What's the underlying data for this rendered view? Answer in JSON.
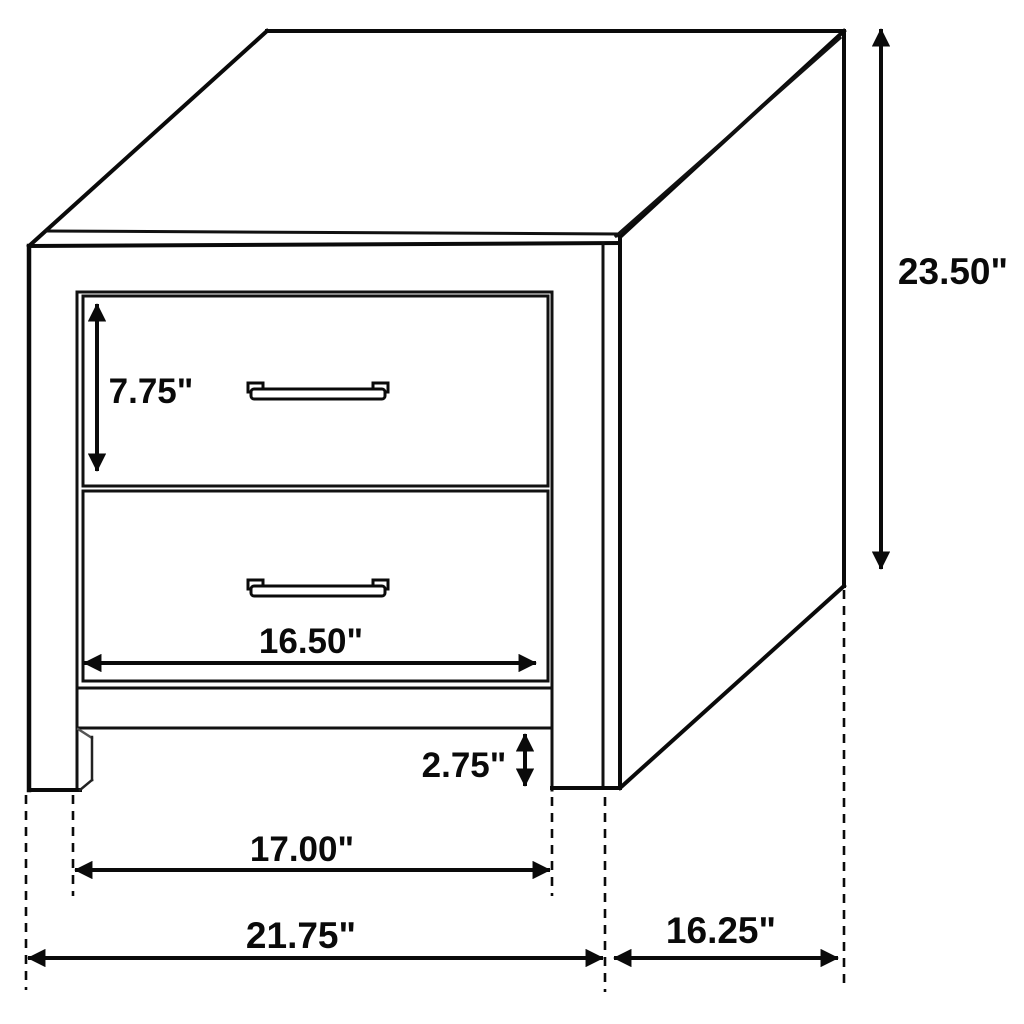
{
  "diagram": {
    "unit": "inches",
    "labels": {
      "overall_height": "23.50\"",
      "top_drawer_height": "7.75\"",
      "drawer_width": "16.50\"",
      "base_clearance": "2.75\"",
      "inner_width": "17.00\"",
      "overall_width": "21.75\"",
      "depth": "16.25\""
    },
    "colors": {
      "line": "#0a0a0a",
      "background": "#ffffff"
    }
  }
}
